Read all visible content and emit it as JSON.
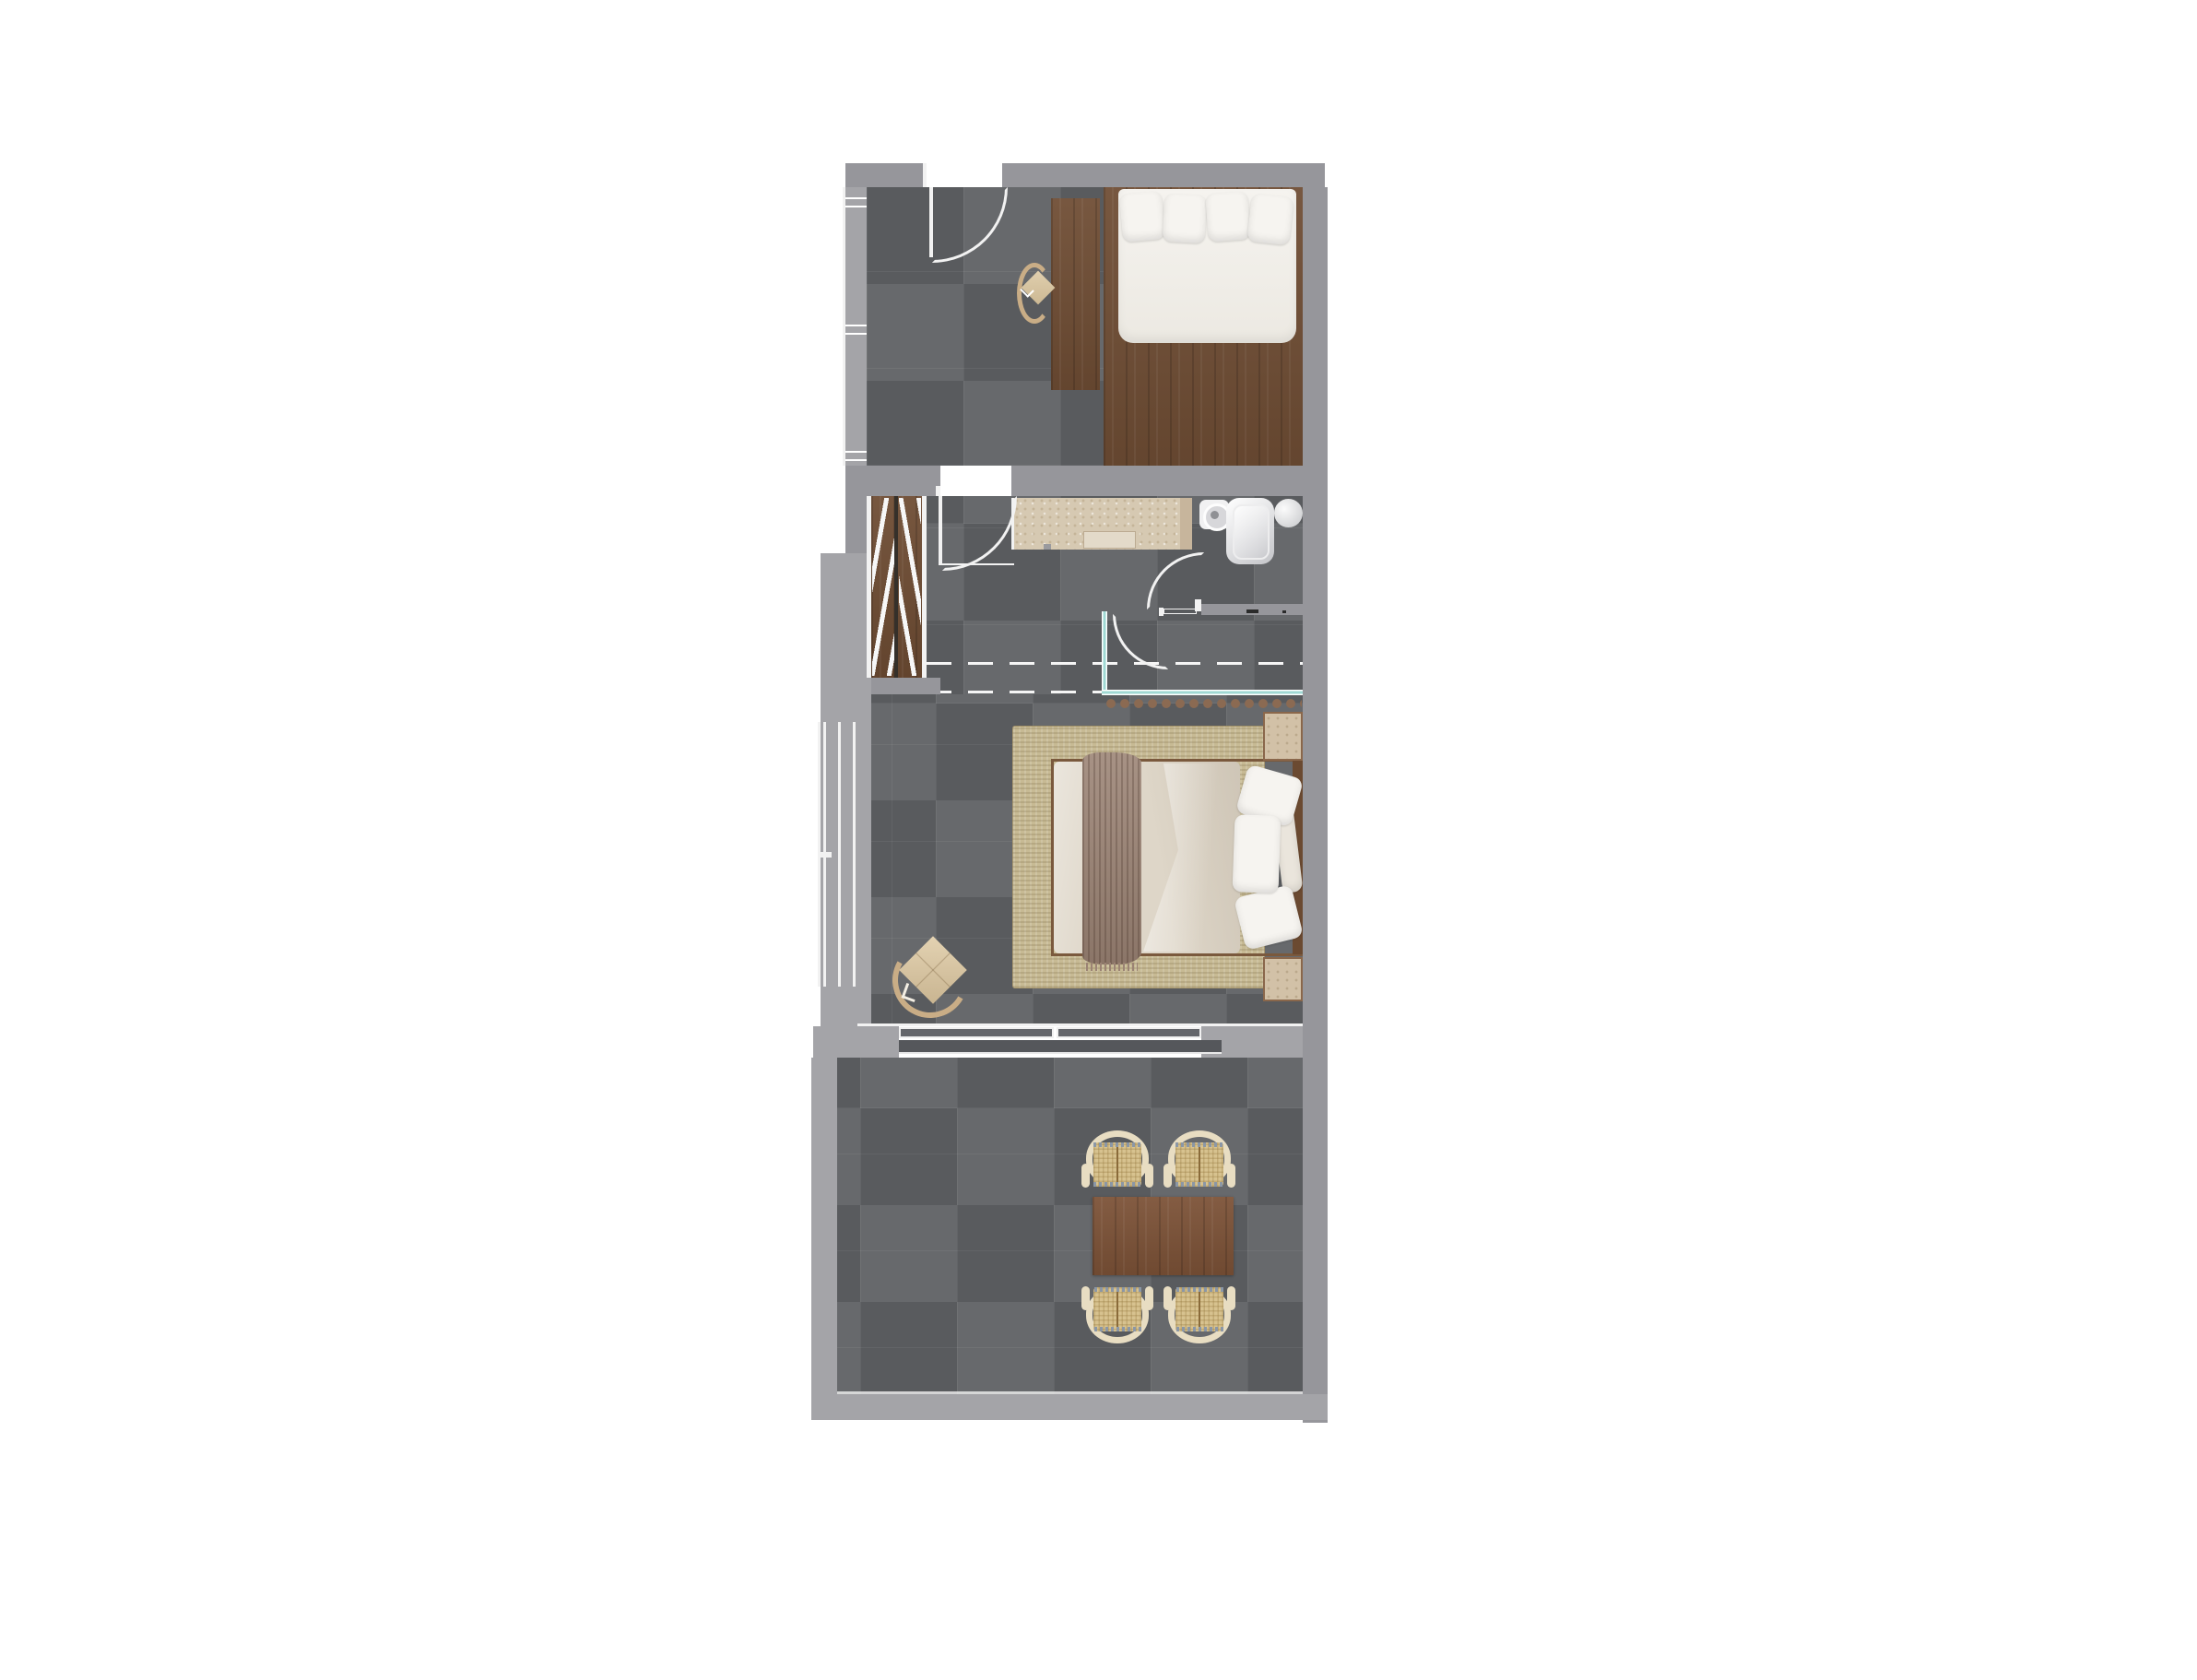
{
  "title": "studio-apartment-floor-plan",
  "colors": {
    "wall": "#96969b",
    "wall_light": "#a4a4a8",
    "floor": "#5f6164",
    "wood": "#6f4d34",
    "wood_table": "#7c5237",
    "wood_frame": "#7a593d",
    "headboard": "#6b4a31",
    "counter": "#d6c9b2",
    "counter_edge": "#c7b59c",
    "sink_inset": "#e3dac9",
    "rug": "#c7ba94",
    "mattress": "#f2f0eb",
    "pillow": "#f6f4f0",
    "duvet": "#ded6c8",
    "throw": "#9b8374",
    "teal": "#9fd8d3",
    "dot": "#8b6a52",
    "cream": "#e8ddc2",
    "rattan": "#d7c28f",
    "fringe": "#8b97a6",
    "chair_wood": "#c9ad86",
    "cushion": "#dbc9a9",
    "stone": "#d2c1a7",
    "stone_edge": "#8a674b",
    "line": "#f2f2f2",
    "fixture": "#c6c7ca",
    "background": "#ffffff"
  },
  "rooms": [
    {
      "name": "bedroom-upper",
      "floor": "dark-grey-tile"
    },
    {
      "name": "corridor-closet",
      "floor": "dark-grey-tile"
    },
    {
      "name": "bathroom",
      "floor": "dark-grey-tile"
    },
    {
      "name": "bedroom-main",
      "floor": "dark-grey-tile"
    },
    {
      "name": "dining-room",
      "floor": "dark-grey-tile"
    }
  ],
  "furniture": [
    {
      "room": "bedroom-upper",
      "name": "platform-bed",
      "detail": "wood base, white mattress, 4 pillows"
    },
    {
      "room": "bedroom-upper",
      "name": "desk",
      "detail": "wood strip beside bed"
    },
    {
      "room": "bedroom-upper",
      "name": "desk-chair",
      "detail": "wishbone chair top view"
    },
    {
      "room": "corridor-closet",
      "name": "wardrobe",
      "detail": "double rail with hangers"
    },
    {
      "room": "bathroom",
      "name": "vanity-counter",
      "detail": "travertine with inset basin"
    },
    {
      "room": "bathroom",
      "name": "round-sink"
    },
    {
      "room": "bathroom",
      "name": "shower-tray"
    },
    {
      "room": "bathroom",
      "name": "round-stool"
    },
    {
      "room": "bedroom-main",
      "name": "double-bed",
      "detail": "cream duvet, brown throw, pillows"
    },
    {
      "room": "bedroom-main",
      "name": "area-rug"
    },
    {
      "room": "bedroom-main",
      "name": "nightstand",
      "count": 2
    },
    {
      "room": "bedroom-main",
      "name": "armchair"
    },
    {
      "room": "dining-room",
      "name": "dining-table"
    },
    {
      "room": "dining-room",
      "name": "rattan-chair",
      "count": 4
    }
  ],
  "openings": [
    {
      "name": "entry-door-upper-bedroom",
      "type": "swing-door"
    },
    {
      "name": "corridor-door",
      "type": "swing-door"
    },
    {
      "name": "bathroom-door",
      "type": "swing-door"
    },
    {
      "name": "bedroom-door",
      "type": "swing-door"
    },
    {
      "name": "glass-partition",
      "type": "fixed-glazing"
    },
    {
      "name": "sliding-door-dining",
      "type": "sliding"
    },
    {
      "name": "window-upper-left",
      "type": "window"
    },
    {
      "name": "window-bedroom-left",
      "type": "window"
    }
  ]
}
